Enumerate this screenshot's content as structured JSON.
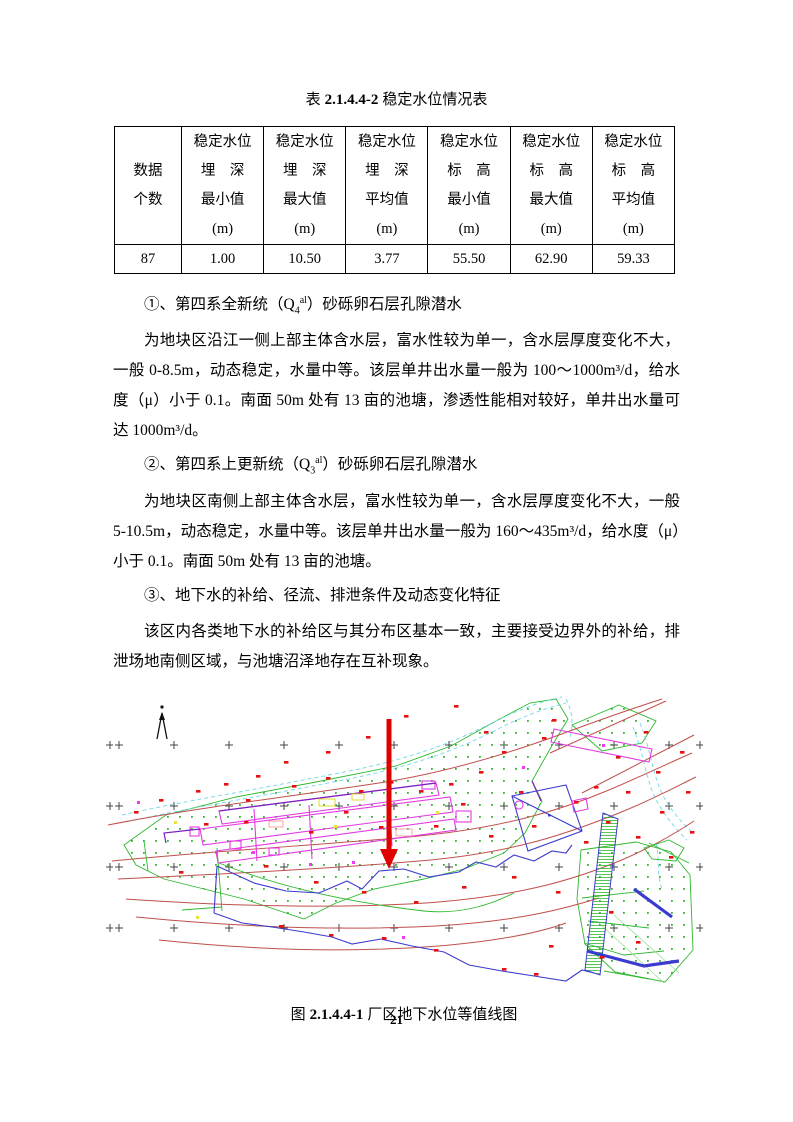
{
  "doc": {
    "table_caption": {
      "prefix": "表",
      "number": "2.1.4.4-2",
      "title": "稳定水位情况表"
    },
    "table": {
      "headers": [
        "数据\n个数",
        "稳定水位\n埋　深\n最小值\n(m)",
        "稳定水位\n埋　深\n最大值\n(m)",
        "稳定水位\n埋　深\n平均值\n(m)",
        "稳定水位\n标　高\n最小值\n(m)",
        "稳定水位\n标　高\n最大值\n(m)",
        "稳定水位\n标　高\n平均值\n(m)"
      ],
      "row": [
        "87",
        "1.00",
        "10.50",
        "3.77",
        "55.50",
        "62.90",
        "59.33"
      ]
    },
    "sections": [
      {
        "heading": {
          "pre": "①、第四系全新统（Q",
          "sub": "4",
          "sup": "al",
          "post": "）砂砾卵石层孔隙潜水"
        },
        "body": "为地块区沿江一侧上部主体含水层，富水性较为单一，含水层厚度变化不大，一般 0-8.5m，动态稳定，水量中等。该层单井出水量一般为 100～1000m³/d，给水度（μ）小于 0.1。南面 50m 处有 13 亩的池塘，渗透性能相对较好，单井出水量可达 1000m³/d。"
      },
      {
        "heading": {
          "pre": "②、第四系上更新统（Q",
          "sub": "3",
          "sup": "al",
          "post": "）砂砾卵石层孔隙潜水"
        },
        "body": "为地块区南侧上部主体含水层，富水性较为单一，含水层厚度变化不大，一般 5-10.5m，动态稳定，水量中等。该层单井出水量一般为 160～435m³/d，给水度（μ）小于 0.1。南面 50m 处有 13 亩的池塘。"
      },
      {
        "heading": {
          "pre": "③、地下水的补给、径流、排泄条件及动态变化特征",
          "sub": "",
          "sup": "",
          "post": ""
        },
        "body": "该区内各类地下水的补给区与其分布区基本一致，主要接受边界外的补给，排泄场地南侧区域，与池塘沼泽地存在互补现象。"
      }
    ],
    "figure_caption": {
      "prefix": "图",
      "number": "2.1.4.4-1",
      "title": "厂区地下水位等值线图"
    },
    "page_number": "21",
    "map_colors": {
      "contour_line": "#c0504d",
      "building_outline": "#e33ae3",
      "water_boundary": "#3b3bd0",
      "vegetation": "#2db82d",
      "stream": "#6fd8e8",
      "survey_marker": "#e81111",
      "site_arrow": "#e00000"
    }
  }
}
